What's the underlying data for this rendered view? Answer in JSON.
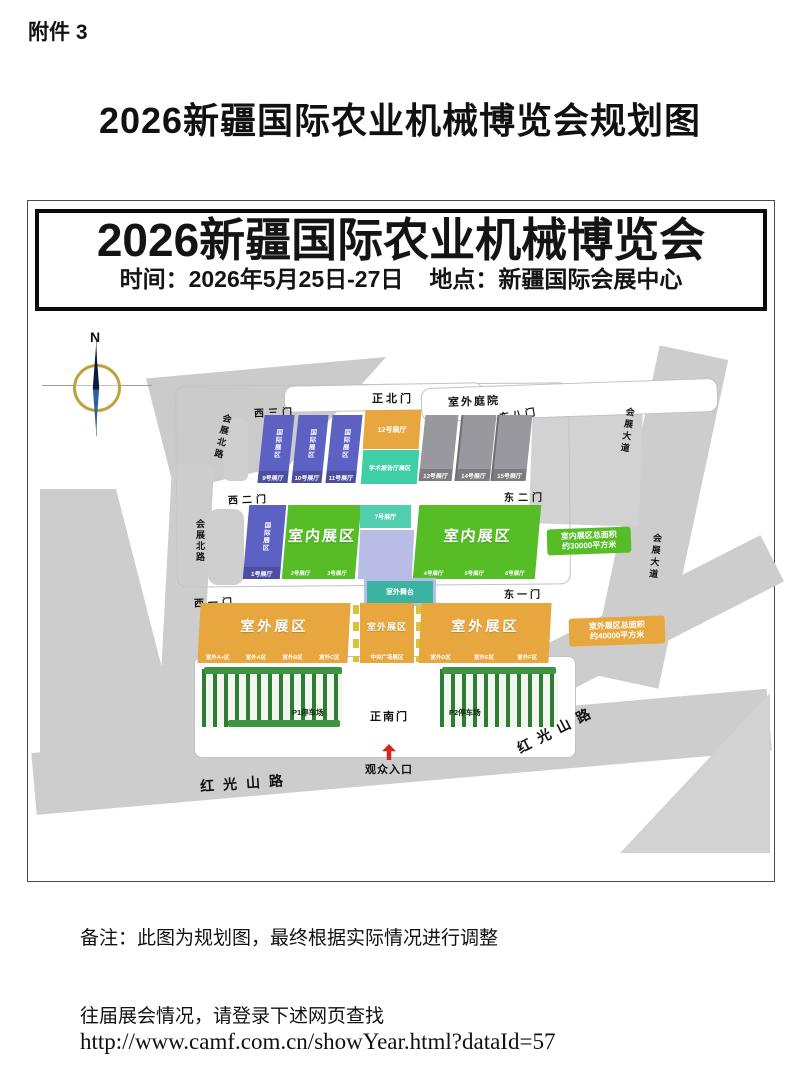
{
  "doc": {
    "attachment": "附件 3",
    "title": "2026新疆国际农业机械博览会规划图",
    "note": "备注：此图为规划图，最终根据实际情况进行调整",
    "past_line": "往届展会情况，请登录下述网页查找",
    "url": "http://www.camf.com.cn/showYear.html?dataId=57"
  },
  "banner": {
    "title": "2026新疆国际农业机械博览会",
    "time_label": "时间：2026年5月25日-27日",
    "venue_label": "地点：新疆国际会展中心"
  },
  "map": {
    "compass_n": "N",
    "gates": {
      "north_main": "正北门",
      "west3": "西三门",
      "east8": "东八门",
      "west2": "西二门",
      "east2": "东二门",
      "west1": "西一门",
      "east1": "东一门",
      "south_main": "正南门"
    },
    "courtyard": "室外庭院",
    "roads": {
      "huizhan_north": "会展北路",
      "huizhan_avenue": "会展大道",
      "hongguangshan": "红光山路"
    },
    "halls_top": [
      {
        "zone": "国际展区",
        "label": "9号展厅"
      },
      {
        "zone": "国际展区",
        "label": "10号展厅"
      },
      {
        "zone": "国际展区",
        "label": "11号展厅"
      }
    ],
    "hall12": "12号展厅",
    "academic_block": "学术报告厅展区",
    "gray_halls": [
      "13号展厅",
      "14号展厅",
      "15号展厅"
    ],
    "hall1": {
      "zone": "国际展区",
      "label": "1号展厅"
    },
    "indoor_west": {
      "title": "室内展区",
      "halls": [
        "2号展厅",
        "3号展厅"
      ]
    },
    "hall7": "7号展厅",
    "indoor_east": {
      "title": "室内展区",
      "halls": [
        "4号展厅",
        "5号展厅",
        "6号展厅"
      ]
    },
    "indoor_note": {
      "line1": "室内展区总面积",
      "line2": "约30000平方米"
    },
    "stage": "室外舞台",
    "outdoor_west": {
      "title": "室外展区",
      "zones": [
        "室外A+区",
        "室外A区",
        "室外B区",
        "室外C区"
      ]
    },
    "outdoor_center": {
      "title": "室外展区",
      "zone": "中央广场展区"
    },
    "outdoor_east": {
      "title": "室外展区",
      "zones": [
        "室外D区",
        "室外E区",
        "室外F区"
      ]
    },
    "outdoor_note": {
      "line1": "室外展区总面积",
      "line2": "约40000平方米"
    },
    "parking_p1": "P1停车场",
    "parking_p2": "P2停车场",
    "visitor_entrance": "观众入口",
    "colors": {
      "hall_blue": "#5d61c4",
      "indoor_green": "#56bd27",
      "teal": "#3ecfa6",
      "hall_gray": "#99989e",
      "lavender": "#b9bce4",
      "outdoor_orange": "#e8a73e",
      "road_gray": "#cbcbcb",
      "arrow_red": "#d5281c"
    }
  }
}
